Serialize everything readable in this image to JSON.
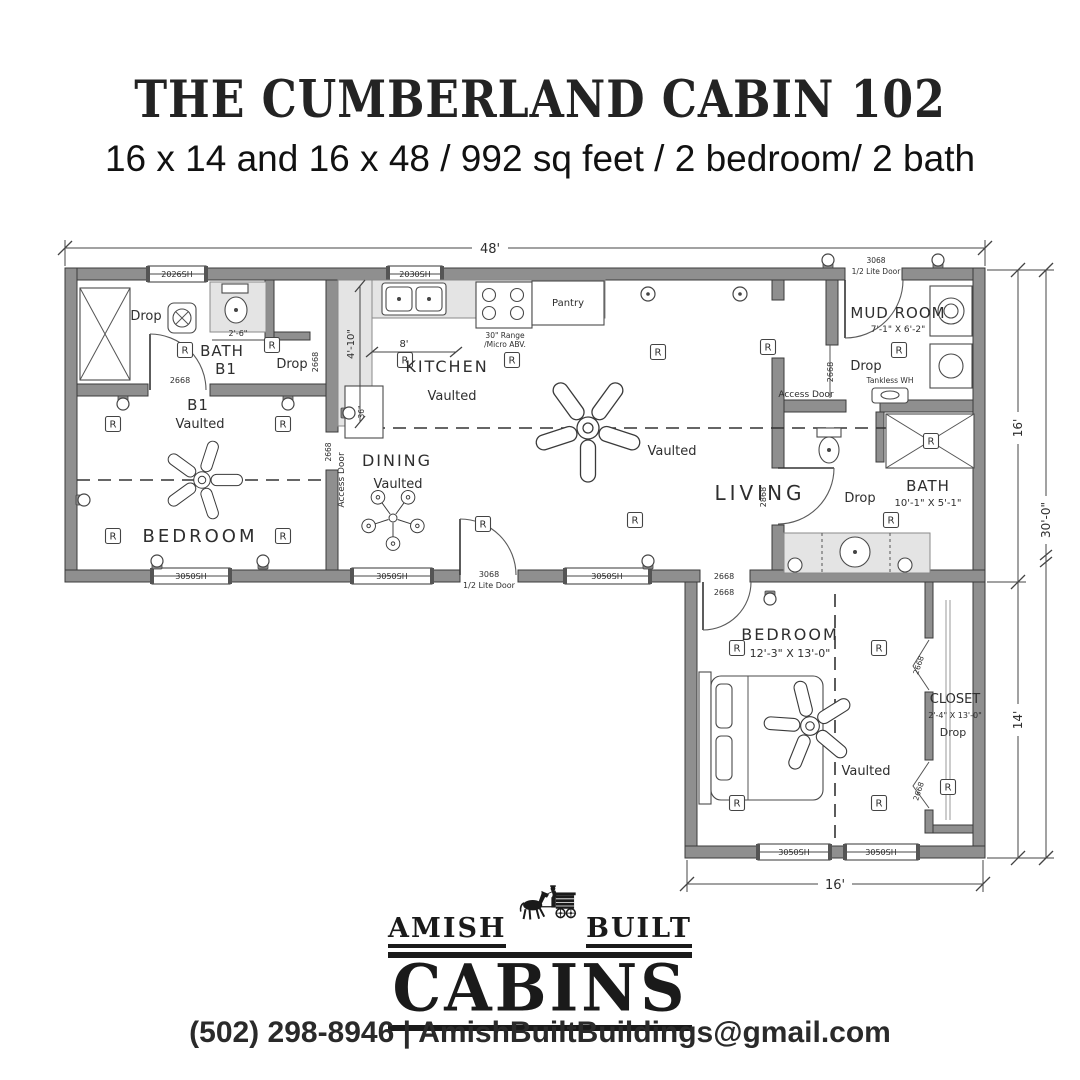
{
  "header": {
    "title": "THE CUMBERLAND CABIN 102",
    "subtitle": "16 x 14 and 16 x 48 / 992 sq feet / 2 bedroom/ 2 bath"
  },
  "plan": {
    "dims": {
      "overall_width": "48'",
      "upper_depth": "16'",
      "lower_depth": "14'",
      "overall_depth": "30'-0\"",
      "lower_width": "16'",
      "kitchen_width": "8'",
      "kitchen_depth": "4'-10\"",
      "bath1_nook": "2'-6\"",
      "rail": "36\""
    },
    "windows": {
      "w2026": "2026SH",
      "w2030": "2030SH",
      "w3050": "3050SH"
    },
    "doors": {
      "d3068": "3068",
      "half_lite": "1/2 Lite Door",
      "d2668": "2668",
      "d2868": "2868"
    },
    "rooms": {
      "bath1": {
        "name": "BATH",
        "code": "B1",
        "drop": "Drop"
      },
      "closet1_drop": "Drop",
      "bed1": {
        "code": "B1",
        "ceiling": "Vaulted",
        "name": "BEDROOM"
      },
      "kitchen": {
        "name": "KITCHEN",
        "ceiling": "Vaulted",
        "pantry": "Pantry",
        "range_note1": "30\" Range",
        "range_note2": "/Micro ABV."
      },
      "dining": {
        "name": "DINING",
        "ceiling": "Vaulted",
        "access_door": "Access Door"
      },
      "living": {
        "name": "LIVING",
        "ceiling": "Vaulted"
      },
      "mud": {
        "name": "MUD ROOM",
        "size": "7'-1\" X 6'-2\"",
        "drop": "Drop",
        "tankless": "Tankless WH",
        "access_door": "Access Door"
      },
      "bath2": {
        "name": "BATH",
        "size": "10'-1\" X 5'-1\"",
        "drop": "Drop"
      },
      "bed2": {
        "name": "BEDROOM",
        "size": "12'-3\" X 13'-0\"",
        "ceiling": "Vaulted"
      },
      "closet2": {
        "name": "CLOSET",
        "size": "2'-4\" X 13'-0\"",
        "drop": "Drop"
      }
    },
    "symbols": {
      "receptacle": "R"
    }
  },
  "logo": {
    "word_left": "AMISH",
    "word_right": "BUILT",
    "word_main": "CABINS"
  },
  "footer": {
    "contact": "(502) 298-8946 | AmishBuiltBuildings@gmail.com"
  }
}
